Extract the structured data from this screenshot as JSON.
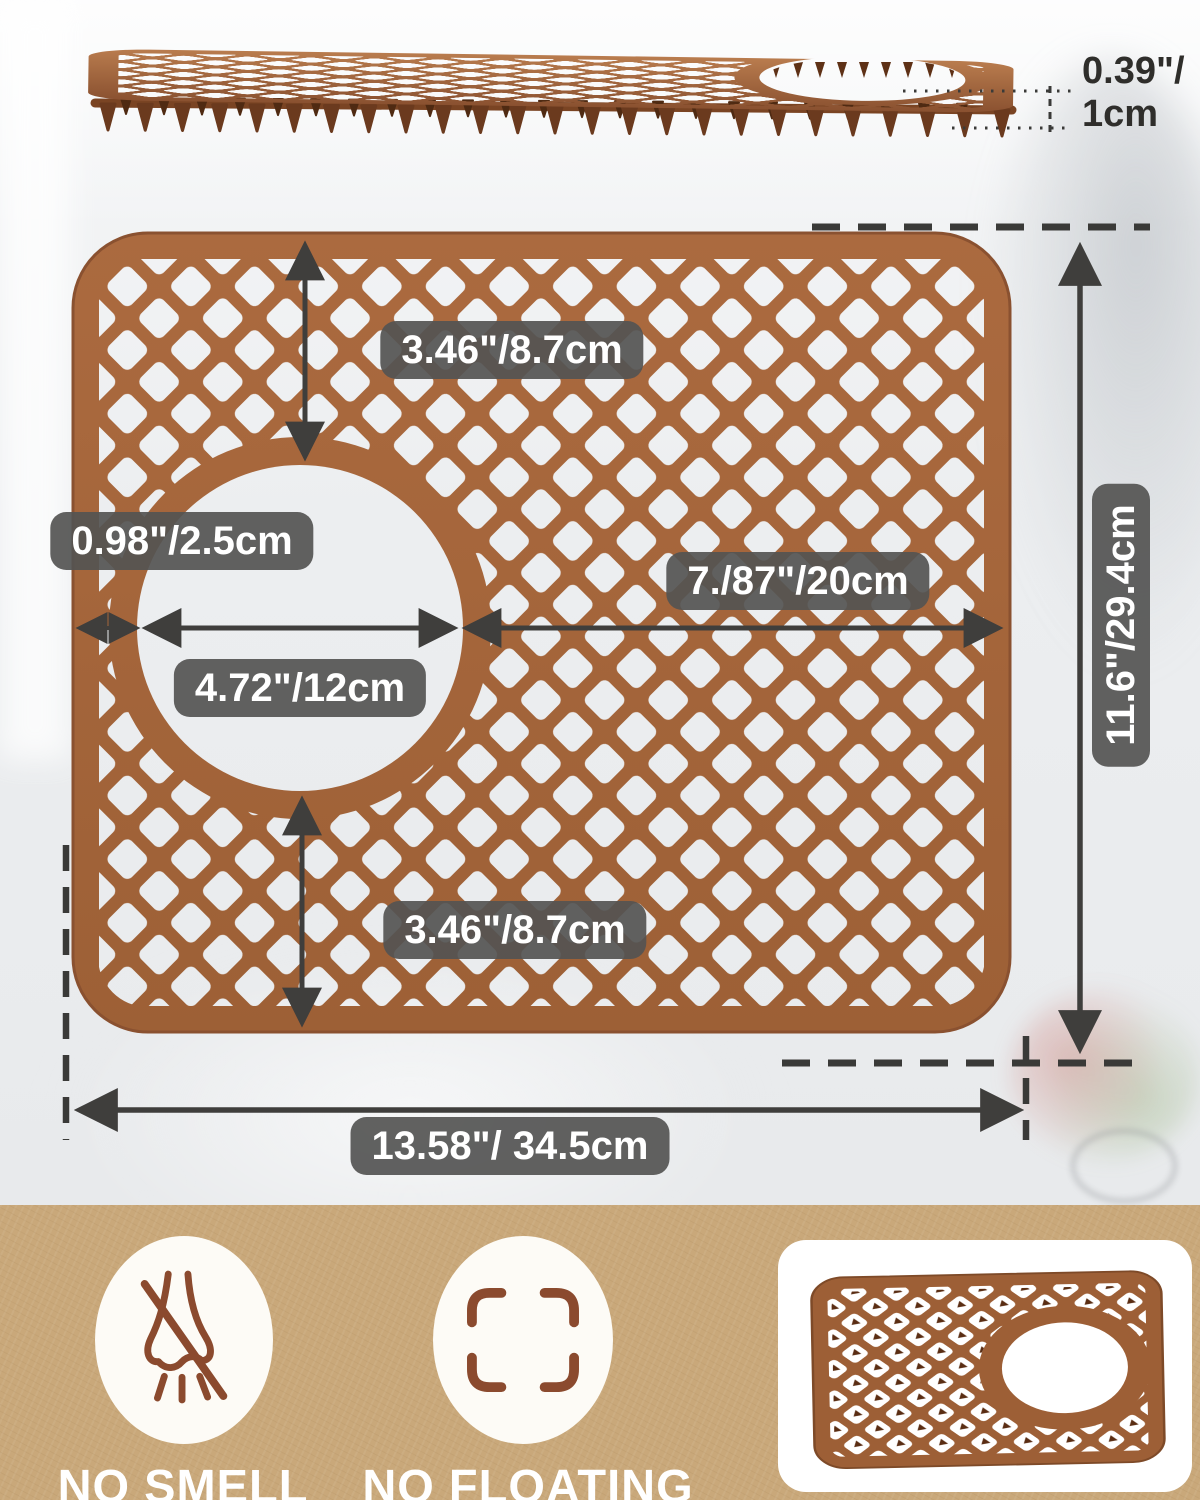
{
  "side_view": {
    "thickness_line1": "0.39\"/",
    "thickness_line2": "1cm"
  },
  "diagram": {
    "top_height": "3.46\"/8.7cm",
    "edge_to_hole": "0.98\"/2.5cm",
    "hole_diameter": "4.72\"/12cm",
    "hole_to_edge": "7./87\"/20cm",
    "total_height": "11.6\"/29.4cm",
    "bottom_height": "3.46\"/8.7cm",
    "total_width": "13.58\"/ 34.5cm"
  },
  "features": [
    {
      "icon": "no-smell-nose-icon",
      "label": "NO SMELL"
    },
    {
      "icon": "no-floating-frame-icon",
      "label": "NO FLOATING"
    }
  ],
  "colors": {
    "mat_brown": "#a5663c",
    "mat_dark": "#7a4423",
    "dimension_gray": "#3f3e3c",
    "badge_bg": "#545452",
    "band_tan": "#c9a87a",
    "icon_brown": "#8b4a2e"
  }
}
